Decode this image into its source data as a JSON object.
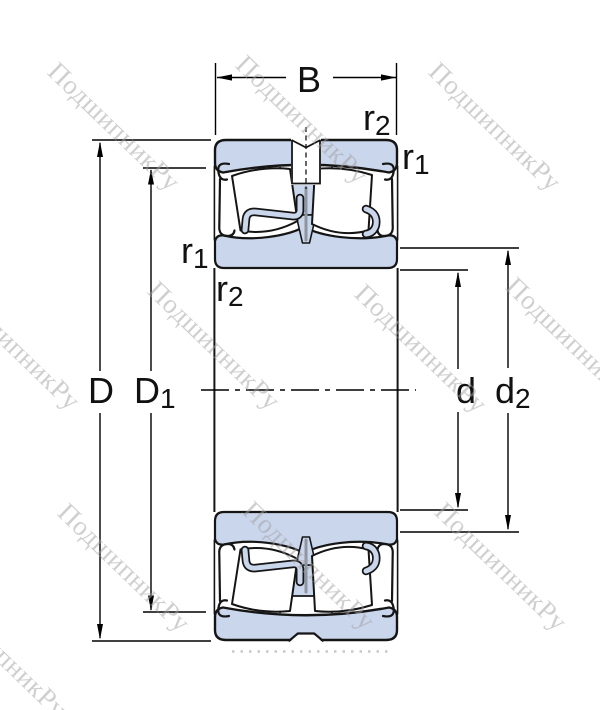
{
  "diagram": {
    "title": "bearing-cross-section-dimensional-drawing",
    "dimension_labels": {
      "B": {
        "main": "B",
        "sub": ""
      },
      "D": {
        "main": "D",
        "sub": ""
      },
      "D1": {
        "main": "D",
        "sub": "1"
      },
      "d": {
        "main": "d",
        "sub": ""
      },
      "d2": {
        "main": "d",
        "sub": "2"
      },
      "r1": {
        "main": "r",
        "sub": "1"
      },
      "r2": {
        "main": "r",
        "sub": "2"
      }
    },
    "colors": {
      "bearing_fill": "#c9d6eb",
      "outline": "#151515",
      "dimension_lines": "#000000",
      "cage_slot": "#8f959e",
      "watermark": "#a29e9e"
    }
  },
  "watermark": {
    "text": "ПодшипникРу"
  }
}
